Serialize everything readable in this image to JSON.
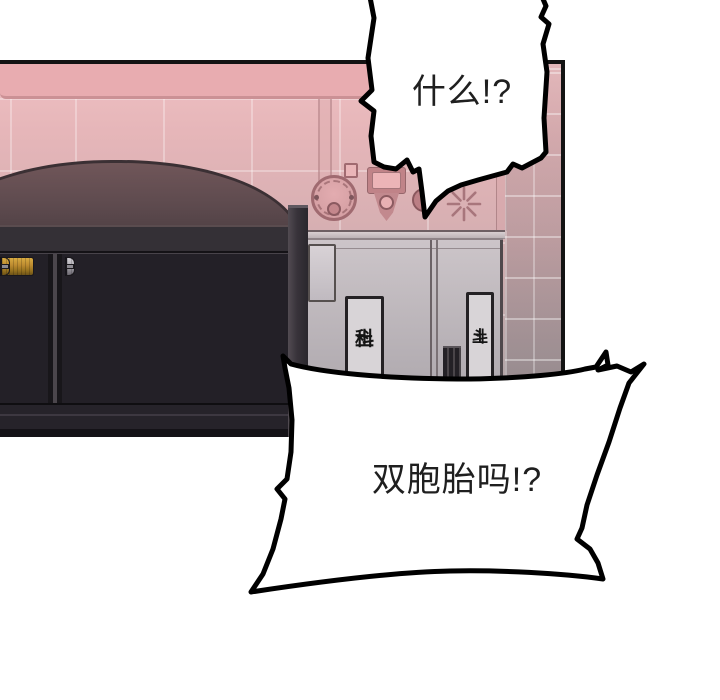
{
  "scene": {
    "bubbles": {
      "top": {
        "text": "什么!?"
      },
      "bottom": {
        "text": "双胞胎吗!?"
      }
    },
    "cabinet": {
      "plates": [
        {
          "glyphs": [
            "土",
            "科"
          ]
        },
        {
          "glyphs": [
            "土",
            "斗"
          ]
        }
      ]
    },
    "machine": {
      "left_rack_rows": [
        "silver",
        "gold",
        "silver",
        "gold",
        "silver",
        "gold"
      ],
      "main_rack_rows": 6,
      "main_rack_pattern": [
        "silver",
        "gold",
        "silver",
        "gold",
        "silver",
        "gold",
        "silver"
      ]
    },
    "colors": {
      "wall_pink": "#eab4b7",
      "wall_gray": "#a69c9e",
      "beam_pink": "#e8acb0",
      "dome": "#5d4a4e",
      "roller_gold": "#bd8c30",
      "roller_silver": "#b4b1b8",
      "frame_dark": "#232027",
      "panel_border": "#131313",
      "equipment_rose": "#b97f85",
      "bubble_outline": "#000000"
    }
  }
}
